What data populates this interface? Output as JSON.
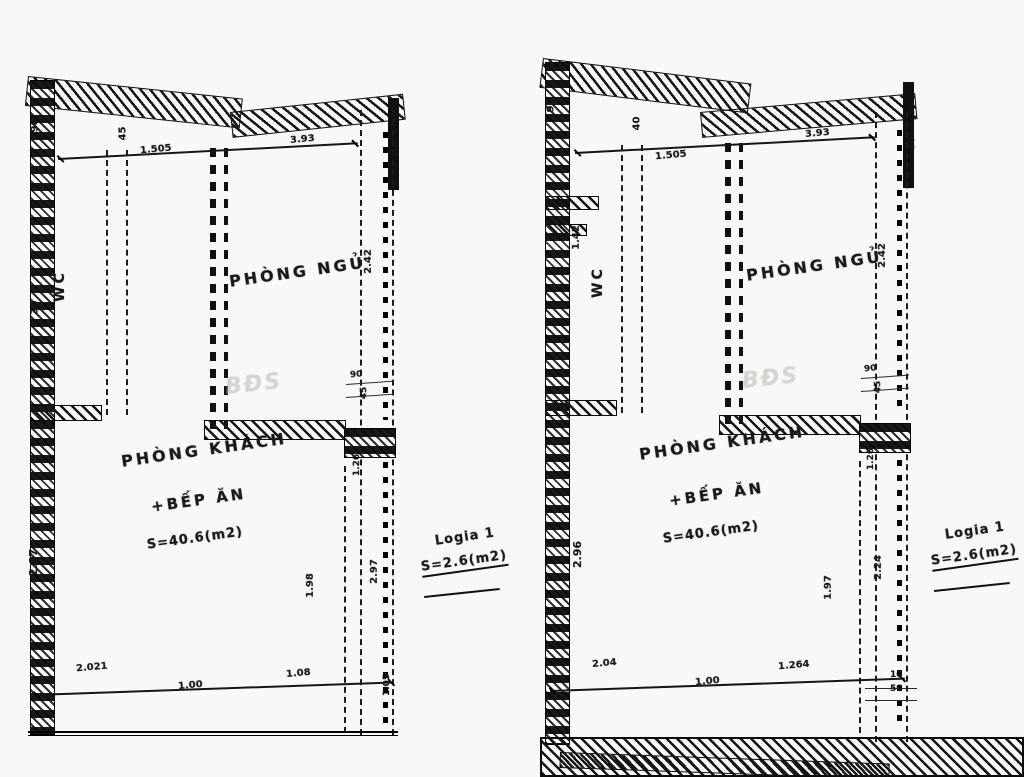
{
  "drawing": {
    "type": "apartment floor plan, two units side by side (scanned)",
    "watermark": "BĐS",
    "ink_color": "#161616",
    "paper_color": "#f8f8f6"
  },
  "plans": [
    {
      "id": "left-unit",
      "rooms": {
        "bedroom": "PHÒNG NGỦ",
        "wc": "WC",
        "living_line1": "PHÒNG KHÁCH",
        "living_line2": "+BẾP ĂN",
        "living_area": "S=40.6(m2)"
      },
      "logia": {
        "name": "Logia 1",
        "area": "S=2.6(m2)"
      },
      "dims": {
        "top_left_h": "90",
        "top_mid_h": "45",
        "top_w1": "1.505",
        "top_w2": "3.93",
        "right_t1": "30",
        "right_t2": "30",
        "left_upper": "30",
        "left_main": "2.87",
        "bedroom_h": "2.42",
        "logia_t1": "90",
        "logia_t2": "45",
        "logia_m": "1.26",
        "living_v": "1.98",
        "logia_v": "2.97",
        "bot_w1": "2.021",
        "bot_w2": "1.00",
        "bot_w3": "1.08",
        "bot_r": "1.05"
      }
    },
    {
      "id": "right-unit",
      "rooms": {
        "bedroom": "PHÒNG NGỦ",
        "wc": "WC",
        "living_line1": "PHÒNG KHÁCH",
        "living_line2": "+BẾP ĂN",
        "living_area": "S=40.6(m2)"
      },
      "logia": {
        "name": "Logia 1",
        "area": "S=2.6(m2)"
      },
      "dims": {
        "top_left_h": "90",
        "top_mid_h": "40",
        "top_w1": "1.505",
        "top_w2": "3.93",
        "right_t1": "30",
        "right_t2": "30",
        "left_upper": "1.42",
        "left_main": "2.96",
        "bedroom_h": "2.42",
        "logia_t1": "90",
        "logia_t2": "45",
        "logia_m": "1.26",
        "living_v": "1.97",
        "logia_v": "2.24",
        "bot_w1": "2.04",
        "bot_w2": "1.00",
        "bot_w3": "1.264",
        "bot_r1": "10",
        "bot_r2": "50"
      }
    }
  ]
}
